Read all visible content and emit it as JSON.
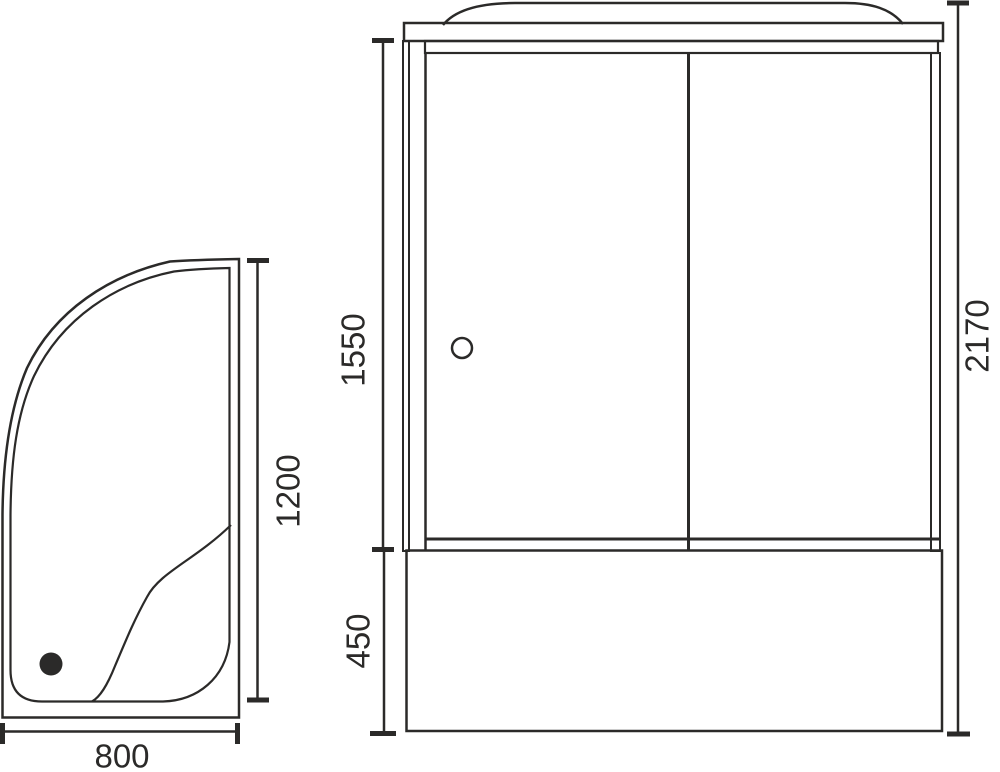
{
  "meta": {
    "drawing_type": "shower-enclosure-technical-drawing",
    "background_color": "#ffffff",
    "line_color": "#2b2a29"
  },
  "top_view": {
    "name": "tray top view",
    "width_label": "800",
    "depth_label": "1200"
  },
  "front_view": {
    "name": "cabin front view",
    "door_section_label": "1550",
    "base_section_label": "450",
    "total_height_label": "2170"
  }
}
